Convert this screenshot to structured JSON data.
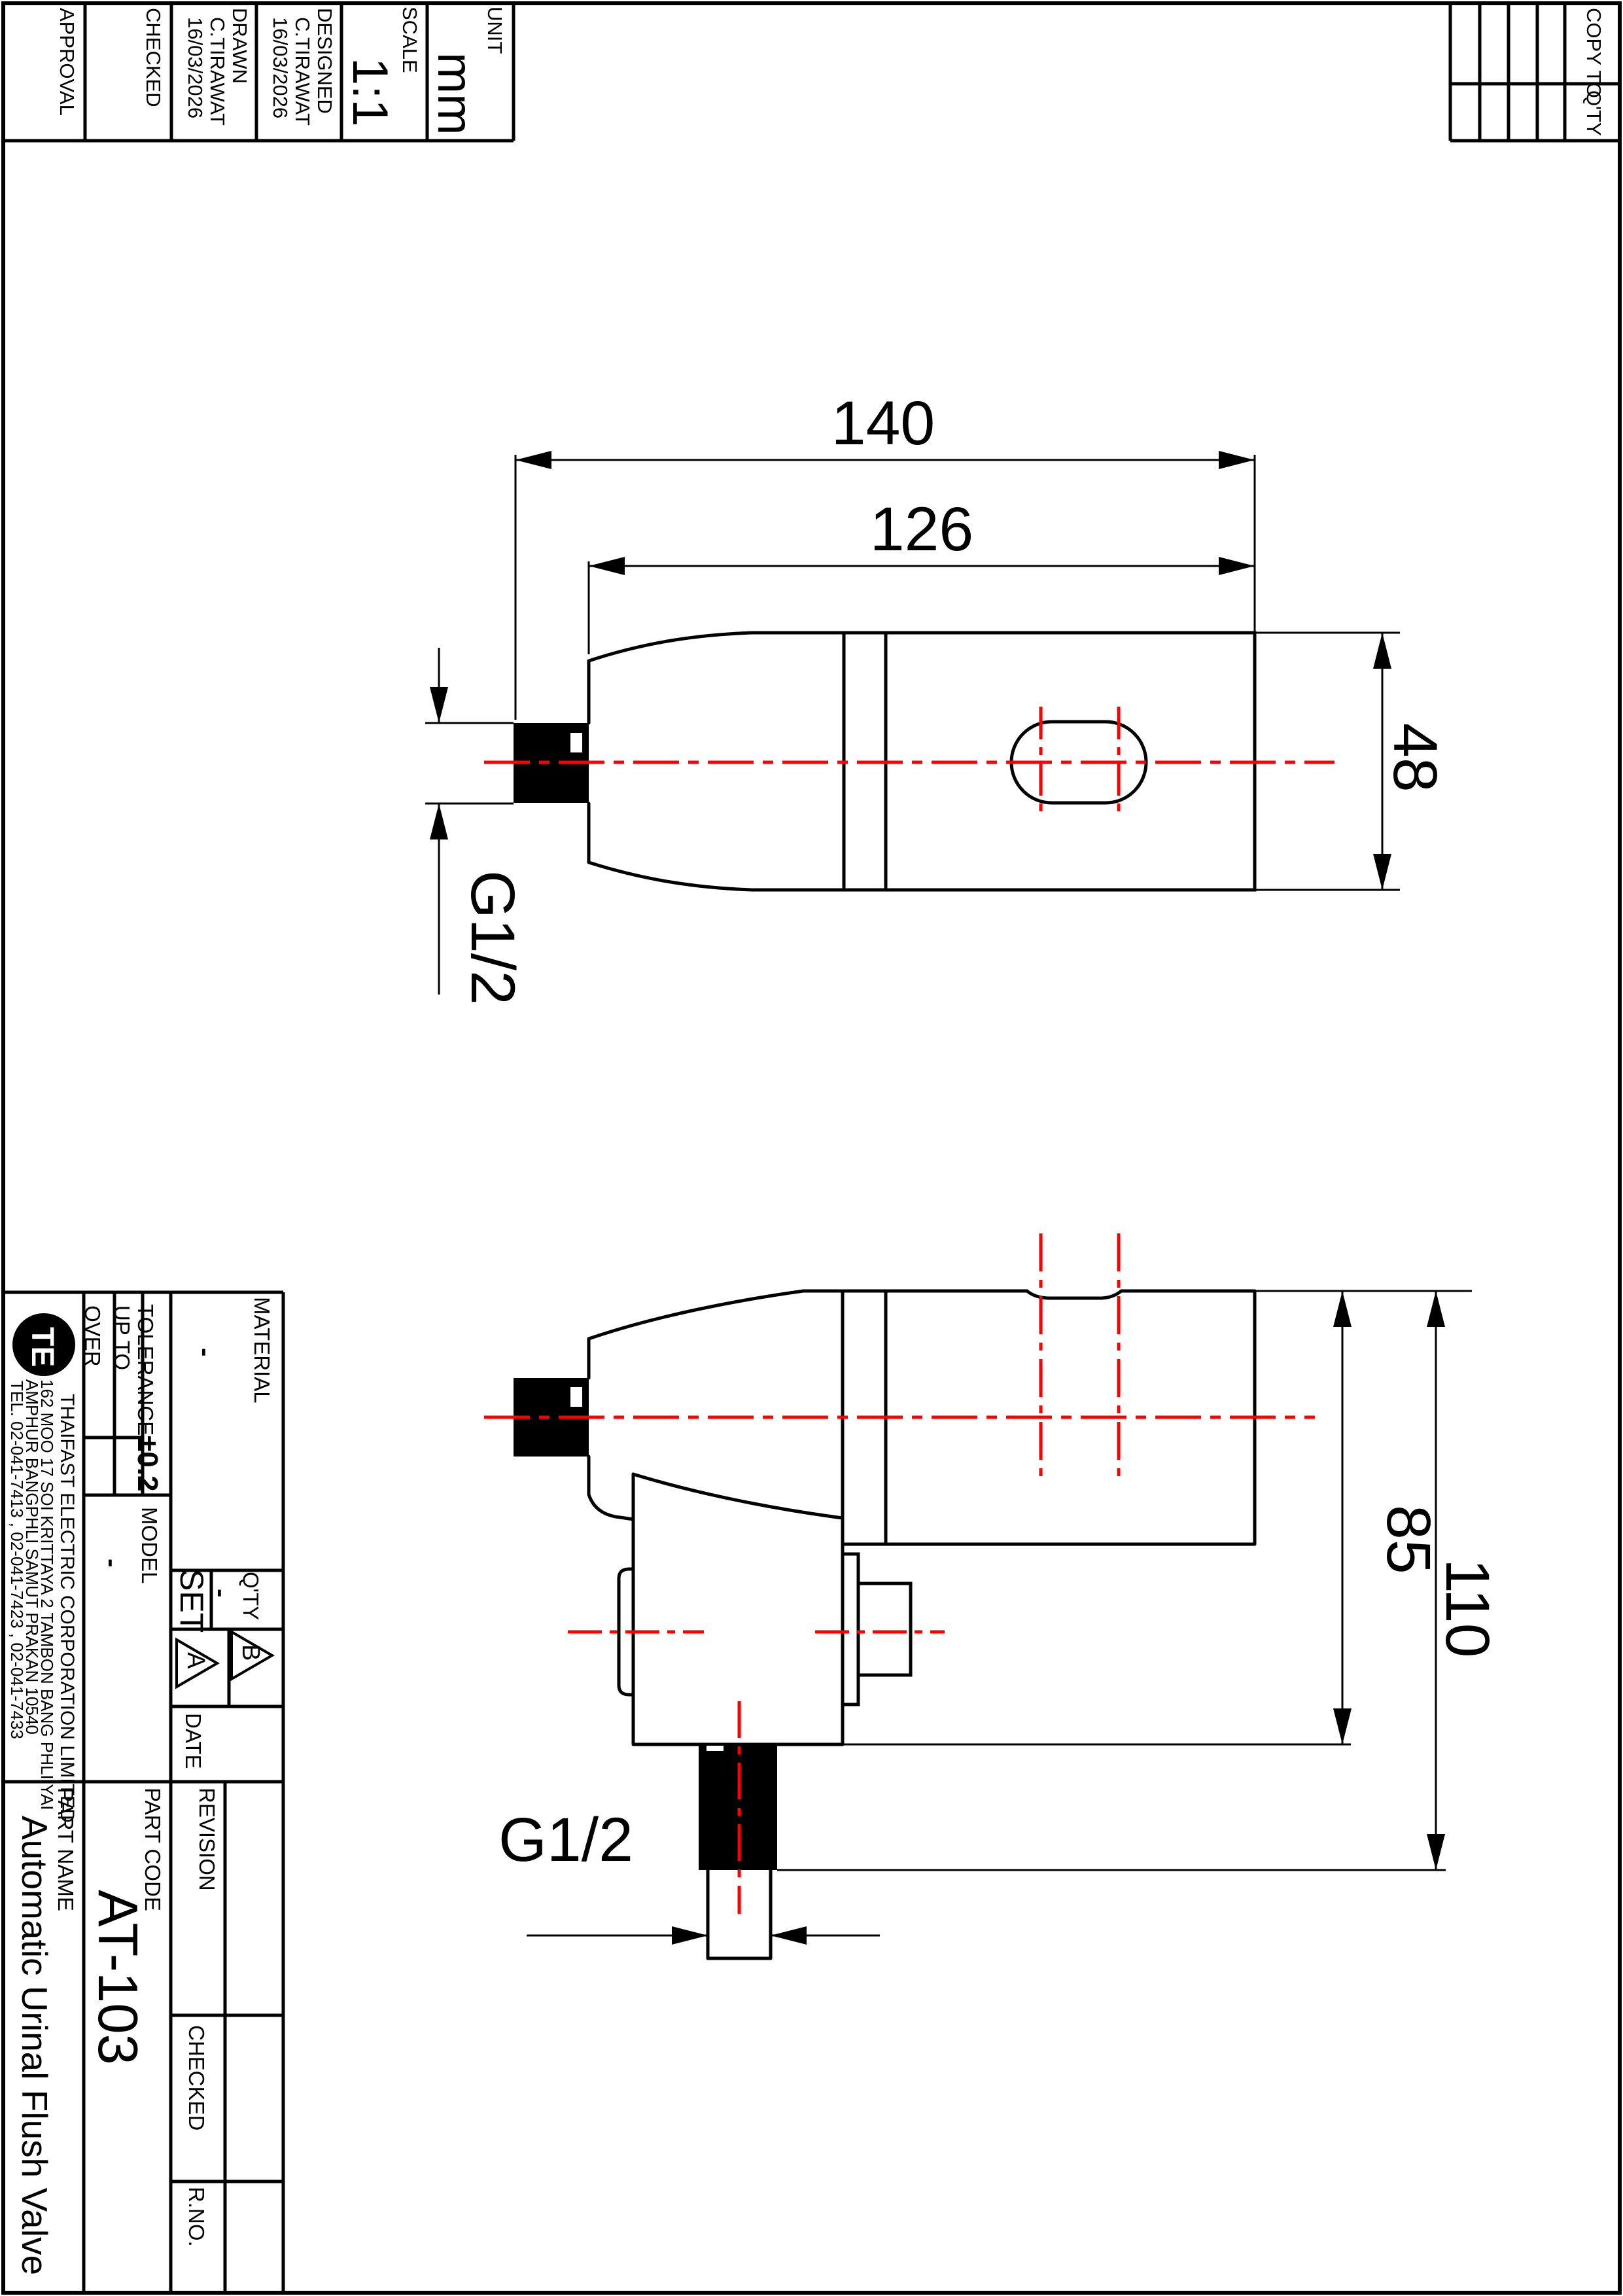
{
  "colors": {
    "line": "#000000",
    "centerline": "#ff0000",
    "background": "#ffffff"
  },
  "header_left": {
    "columns": [
      {
        "label": "APPROVAL",
        "name": "",
        "date": ""
      },
      {
        "label": "CHECKED",
        "name": "",
        "date": ""
      },
      {
        "label": "DRAWN",
        "name": "C.TIRAWAT",
        "date": "16/03/2026"
      },
      {
        "label": "DESIGNED",
        "name": "C.TIRAWAT",
        "date": "16/03/2026"
      },
      {
        "label": "SCALE",
        "value": "1:1"
      },
      {
        "label": "UNIT",
        "value": "mm"
      }
    ]
  },
  "header_right": {
    "col_label_1": "COPY TO",
    "col_label_2": "Q'TY"
  },
  "dims": {
    "overall_length": "140",
    "body_length": "126",
    "body_height": "48",
    "inlet_thread": "G1/2",
    "mount_face_height": "85",
    "overall_height": "110",
    "outlet_thread": "G1/2"
  },
  "title_block": {
    "company_name": "THAIFAST ELECTRIC CORPORATION LIMITED",
    "address_line_1": "162 MOO 17 SOI KRITTAYA 2 TAMBON BANG PHLI YAI",
    "address_line_2": "AMPHUR BANGPHLI SAMUT PRAKAN 10540",
    "address_line_3": "TEL. 02-041-7413 , 02-041-7423 , 02-041-7433",
    "logo_text": "TE",
    "tolerance_label": "TOLERANCE",
    "tolerance_value": "±0.2",
    "up_to_label": "UP TO",
    "over_label": "OVER",
    "material_label": "MATERIAL",
    "material_value": "-",
    "model_label": "MODEL",
    "model_value": "-",
    "qty_label": "Q'TY",
    "qty_value": "-",
    "qty_unit": "SET",
    "rev_marker_a": "A",
    "rev_marker_b": "B",
    "date_label": "DATE",
    "revision_label": "REVISION",
    "part_code_label": "PART CODE",
    "part_code_value": "AT-103",
    "part_name_label": "PART NAME",
    "part_name_value": "Automatic Urinal Flush Valve",
    "checked_label": "CHECKED",
    "r_no_label": "R.NO."
  }
}
